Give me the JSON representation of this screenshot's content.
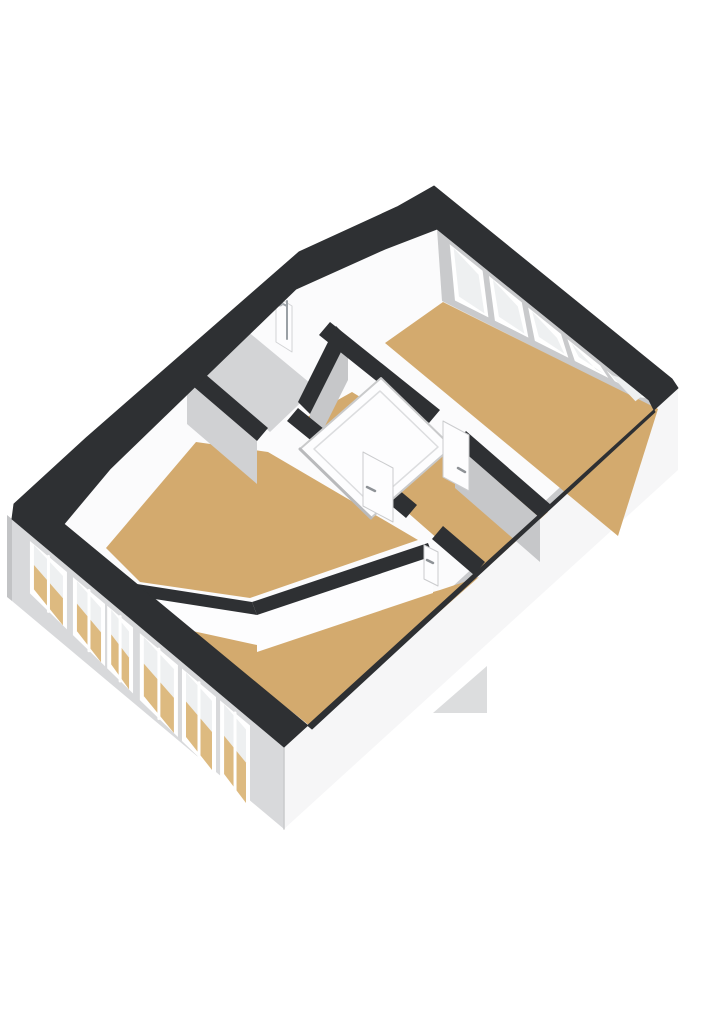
{
  "title": "3d-floor-plan-attic-storey",
  "canvas": {
    "width": 724,
    "height": 1024,
    "background": "#ffffff"
  },
  "colors": {
    "wall_cut_band": "#2e3033",
    "interior_plate": "#fbfbfc",
    "ne_wall_face": "#c9cacc",
    "se_knee_face": "#c9cacc",
    "gray_wall_face": "#c6c7c9",
    "light_gray_face": "#d0d1d3",
    "floor_wood": "#d3aa6e",
    "floor_wood_through_glass": "#ddba80",
    "floor_bathroom": "#d3d4d6",
    "facade_sw": "#d8d9db",
    "facade_se": "#f6f6f7",
    "facade_edge": "#c2c3c5",
    "window_frame": "#ffffff",
    "window_glass": "#eef0f1",
    "door_leaf": "#fdfdfe",
    "door_edge": "#cbccce",
    "handle_metal": "#8e9296",
    "panel_fill": "#fdfdfe",
    "panel_edge": "#c9cacb",
    "panel_inner_edge": "#dcdddf",
    "panel_shadow": "#b9babc",
    "shower_metal": "#9aa0a5"
  },
  "shapes": [
    {
      "name": "lower-roof-wedge",
      "type": "poly",
      "fill": "#dcddde",
      "pts": [
        433,
        713,
        487,
        666,
        487,
        713
      ]
    },
    {
      "name": "facade-nw-sliver",
      "type": "poly",
      "fill": "#c2c3c5",
      "pts": [
        7,
        515,
        12,
        519,
        12,
        601,
        7,
        597
      ]
    },
    {
      "name": "facade-sw",
      "type": "poly",
      "fill": "#d8d9db",
      "pts": [
        12,
        519,
        284,
        747,
        284,
        829,
        12,
        601
      ]
    },
    {
      "name": "facade-se",
      "type": "poly",
      "fill": "#f6f6f7",
      "pts": [
        284,
        747,
        678,
        388,
        678,
        470,
        284,
        829
      ]
    },
    {
      "name": "facade-corner-edge",
      "type": "line",
      "stroke": "#c9cacc",
      "w": 1.5,
      "pts": [
        284,
        747,
        284,
        829
      ]
    },
    {
      "name": "interior-plate",
      "type": "poly",
      "fill": "#fbfbfc",
      "pts": [
        437,
        229,
        649,
        400,
        655,
        412,
        312,
        729,
        64,
        524,
        110,
        469,
        296,
        289,
        385,
        249
      ]
    },
    {
      "name": "ne-window-wall-face",
      "type": "poly",
      "fill": "#c9cacc",
      "pts": [
        437,
        229,
        649,
        400,
        658,
        410,
        442,
        301
      ]
    },
    {
      "name": "se-knee-wall-face",
      "type": "poly",
      "fill": "#c9cacc",
      "pts": [
        655,
        412,
        312,
        729,
        306,
        722,
        649,
        405
      ]
    },
    {
      "name": "room-floor-bedroom-1",
      "type": "poly",
      "fill": "#d3aa6e",
      "pts": [
        443,
        302,
        658,
        409,
        618,
        536,
        385,
        343
      ]
    },
    {
      "name": "room-floor-bathroom",
      "type": "poly",
      "fill": "#d3d4d6",
      "pts": [
        246,
        330,
        316,
        388,
        270,
        432,
        200,
        372
      ]
    },
    {
      "name": "room-floor-landing",
      "type": "poly",
      "fill": "#d3aa6e",
      "pts": [
        352,
        392,
        548,
        512,
        479,
        575,
        302,
        420
      ]
    },
    {
      "name": "room-floor-bedroom-2",
      "type": "poly",
      "fill": "#d3aa6e",
      "pts": [
        106,
        548,
        196,
        442,
        268,
        452,
        418,
        540,
        250,
        598,
        140,
        582
      ]
    },
    {
      "name": "room-floor-bedroom-3",
      "type": "poly",
      "fill": "#d3aa6e",
      "pts": [
        440,
        590,
        479,
        577,
        310,
        726,
        152,
        601,
        255,
        643
      ]
    },
    {
      "name": "landing-east-wall-face",
      "type": "poly",
      "fill": "#c6c7c9",
      "pts": [
        455,
        444,
        540,
        518,
        540,
        562,
        455,
        488
      ]
    },
    {
      "name": "bathroom-se-wall-face",
      "type": "poly",
      "fill": "#c6c7c9",
      "pts": [
        348,
        338,
        310,
        414,
        310,
        456,
        348,
        380
      ]
    },
    {
      "name": "bathroom-sw-wall-face",
      "type": "poly",
      "fill": "#d0d1d3",
      "pts": [
        187,
        381,
        257,
        441,
        257,
        484,
        187,
        424
      ]
    },
    {
      "name": "divider-wall-face-a",
      "type": "poly",
      "fill": "#fdfdfe",
      "pts": [
        433,
        556,
        257,
        615,
        257,
        652,
        433,
        593
      ]
    },
    {
      "name": "divider-wall-face-b",
      "type": "poly",
      "fill": "#fdfdfe",
      "pts": [
        257,
        615,
        142,
        597,
        142,
        620,
        257,
        645
      ]
    },
    {
      "name": "wall-top-bedroom1-a",
      "type": "poly",
      "fill": "#2e3033",
      "pts": [
        330,
        322,
        440,
        410,
        429,
        423,
        319,
        335
      ]
    },
    {
      "name": "wall-top-bedroom1-b",
      "type": "poly",
      "fill": "#2e3033",
      "pts": [
        466,
        431,
        551,
        505,
        540,
        518,
        455,
        444
      ]
    },
    {
      "name": "wall-top-bathroom-se",
      "type": "poly",
      "fill": "#2e3033",
      "pts": [
        336,
        326,
        348,
        338,
        310,
        414,
        298,
        402
      ]
    },
    {
      "name": "wall-top-bathroom-sw",
      "type": "poly",
      "fill": "#2e3033",
      "pts": [
        198,
        368,
        268,
        428,
        257,
        441,
        187,
        381
      ]
    },
    {
      "name": "wall-top-landing-sw-a",
      "type": "poly",
      "fill": "#2e3033",
      "pts": [
        298,
        408,
        356,
        455,
        345,
        468,
        287,
        421
      ]
    },
    {
      "name": "wall-top-landing-sw-b",
      "type": "poly",
      "fill": "#2e3033",
      "pts": [
        392,
        484,
        417,
        505,
        406,
        518,
        381,
        497
      ]
    },
    {
      "name": "wall-top-landing-sw-c",
      "type": "poly",
      "fill": "#2e3033",
      "pts": [
        443,
        526,
        485,
        562,
        474,
        575,
        432,
        539
      ]
    },
    {
      "name": "wall-top-divider-a",
      "type": "poly",
      "fill": "#2e3033",
      "pts": [
        428,
        543,
        252,
        602,
        257,
        615,
        433,
        556
      ]
    },
    {
      "name": "wall-top-divider-b",
      "type": "poly",
      "fill": "#2e3033",
      "pts": [
        252,
        602,
        137,
        584,
        142,
        597,
        257,
        615
      ]
    }
  ],
  "stair_bulkhead": {
    "outer": [
      381,
      378,
      452,
      447,
      371,
      518,
      300,
      449
    ],
    "inner": [
      380,
      391,
      438,
      447,
      372,
      505,
      314,
      449
    ],
    "shadow_edge": [
      300,
      449,
      371,
      518
    ]
  },
  "doors": [
    {
      "name": "door-bedroom-2",
      "leaf": [
        363,
        452,
        393,
        468,
        393,
        522,
        363,
        506
      ],
      "handle": [
        367,
        487,
        375,
        491
      ]
    },
    {
      "name": "door-bedroom-1",
      "leaf": [
        443,
        421,
        469,
        435,
        469,
        491,
        443,
        477
      ],
      "handle": [
        458,
        468,
        465,
        472
      ]
    },
    {
      "name": "door-bedroom-3",
      "leaf": [
        424,
        545,
        438,
        552,
        438,
        586,
        424,
        579
      ],
      "handle": [
        427,
        560,
        433,
        563
      ]
    }
  ],
  "shower": {
    "stub_wall": [
      276,
      296,
      292,
      306,
      292,
      352,
      276,
      342
    ],
    "rod": [
      287,
      301,
      287,
      339
    ],
    "arm": [
      287,
      306,
      281,
      303
    ],
    "head": {
      "cx": 280,
      "cy": 303,
      "r": 3.5
    }
  },
  "windows_ne": {
    "top_edge": [
      437,
      229,
      649,
      400
    ],
    "bottom_edge": [
      442,
      301,
      658,
      410
    ],
    "slots": [
      [
        0.06,
        0.215
      ],
      [
        0.245,
        0.4
      ],
      [
        0.43,
        0.585
      ],
      [
        0.615,
        0.77
      ],
      [
        0.8,
        0.955
      ]
    ],
    "top_inset": 5,
    "bottom_inset": 7,
    "glass_inset": 4
  },
  "windows_sw": {
    "top_edge": [
      12,
      519,
      284,
      747
    ],
    "slots": [
      [
        0.066,
        0.202
      ],
      [
        0.224,
        0.342
      ],
      [
        0.35,
        0.445
      ],
      [
        0.47,
        0.61
      ],
      [
        0.625,
        0.75
      ],
      [
        0.765,
        0.875
      ]
    ],
    "top_offset": 7,
    "base_height": 50,
    "height_grow": 36,
    "glass_inset": 4,
    "tan_fraction": 0.55
  },
  "cut_band": {
    "outer": [
      434,
      186,
      672,
      379,
      678,
      388,
      284,
      747,
      12,
      519,
      14,
      504,
      86,
      438,
      299,
      252,
      397,
      207
    ],
    "inner": [
      437,
      229,
      649,
      400,
      655,
      412,
      312,
      729,
      64,
      524,
      110,
      469,
      296,
      289,
      385,
      249
    ]
  }
}
